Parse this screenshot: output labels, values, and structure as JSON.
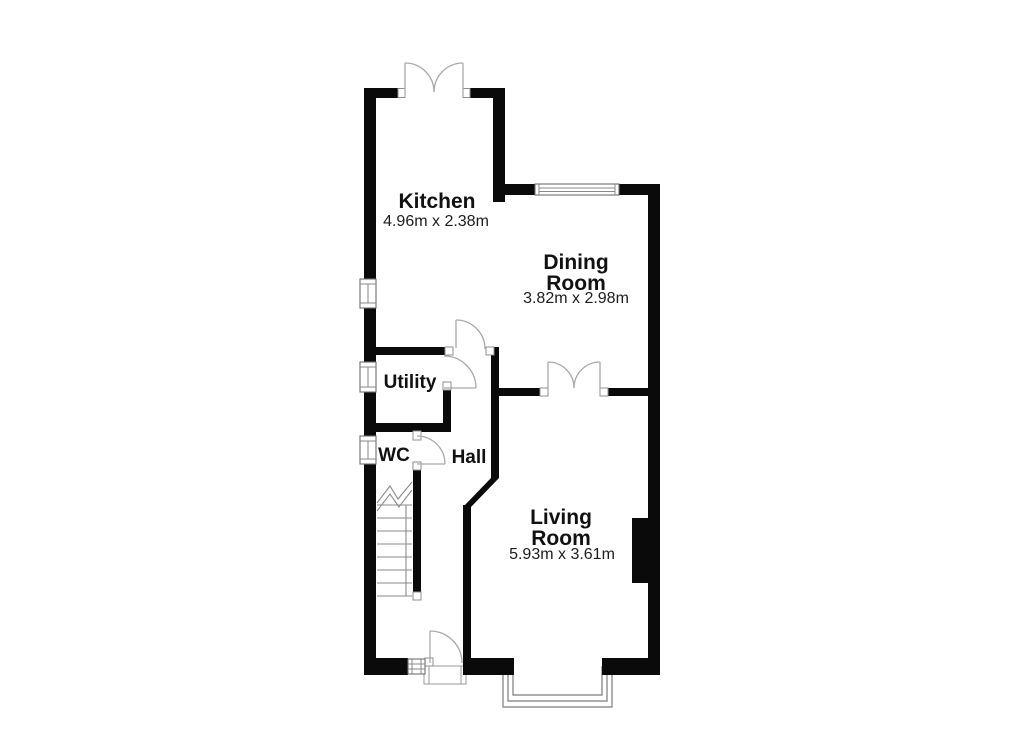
{
  "plan": {
    "type": "ground-floor-plan",
    "colors": {
      "wall": "#0a0a0a",
      "background": "#ffffff",
      "door_line": "#a9a9a9",
      "window_line": "#6e6e6e",
      "text": "#111111"
    },
    "rooms": {
      "kitchen": {
        "name": "Kitchen",
        "dimensions": "4.96m x 2.38m"
      },
      "dining_room": {
        "name_line1": "Dining",
        "name_line2": "Room",
        "dimensions": "3.82m x 2.98m"
      },
      "living_room": {
        "name_line1": "Living",
        "name_line2": "Room",
        "dimensions": "5.93m x 3.61m"
      },
      "utility": {
        "name": "Utility"
      },
      "wc": {
        "name": "WC"
      },
      "hall": {
        "name": "Hall"
      }
    }
  }
}
